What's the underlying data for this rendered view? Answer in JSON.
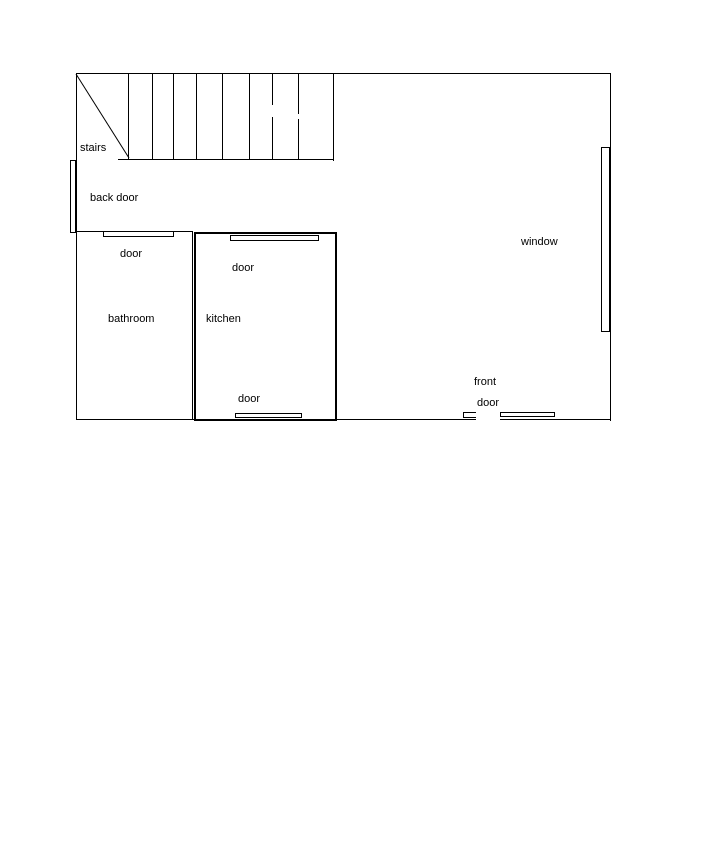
{
  "title": "house ground floor plan",
  "colors": {
    "background": "#ffffff",
    "line": "#000000"
  },
  "floorplan": {
    "labels": {
      "stairs": "stairs",
      "back_door": "back door",
      "bathroom_door": "door",
      "bathroom": "bathroom",
      "kitchen_top_door": "door",
      "kitchen": "kitchen",
      "kitchen_bottom_door": "door",
      "window": "window",
      "front_door_line1": "front",
      "front_door_line2": "door"
    },
    "walls": [
      {
        "name": "top-wall",
        "x": 76,
        "y": 73,
        "w": 535,
        "h": 1
      },
      {
        "name": "left-wall",
        "x": 76,
        "y": 73,
        "w": 1,
        "h": 347
      },
      {
        "name": "right-wall",
        "x": 610,
        "y": 73,
        "w": 1,
        "h": 348
      },
      {
        "name": "bottom-wall-left",
        "x": 76,
        "y": 419,
        "w": 400,
        "h": 1
      },
      {
        "name": "bottom-wall-right",
        "x": 500,
        "y": 419,
        "w": 111,
        "h": 1
      },
      {
        "name": "stairs-right-wall",
        "x": 333,
        "y": 73,
        "w": 1,
        "h": 88
      },
      {
        "name": "stairs-bottom-line",
        "x": 118,
        "y": 159,
        "w": 216,
        "h": 1
      },
      {
        "name": "stair-tread-1",
        "x": 128,
        "y": 74,
        "w": 1,
        "h": 85
      },
      {
        "name": "stair-tread-2",
        "x": 152,
        "y": 74,
        "w": 1,
        "h": 85
      },
      {
        "name": "stair-tread-3",
        "x": 173,
        "y": 74,
        "w": 1,
        "h": 85
      },
      {
        "name": "stair-tread-4",
        "x": 196,
        "y": 74,
        "w": 1,
        "h": 85
      },
      {
        "name": "stair-tread-5",
        "x": 222,
        "y": 74,
        "w": 1,
        "h": 85
      },
      {
        "name": "stair-tread-6",
        "x": 249,
        "y": 74,
        "w": 1,
        "h": 85
      },
      {
        "name": "stair-tread-7-upper",
        "x": 272,
        "y": 74,
        "w": 1,
        "h": 31
      },
      {
        "name": "stair-tread-7-lower",
        "x": 272,
        "y": 117,
        "w": 1,
        "h": 42
      },
      {
        "name": "stair-tread-8-upper",
        "x": 298,
        "y": 74,
        "w": 1,
        "h": 40
      },
      {
        "name": "stair-tread-8-lower",
        "x": 298,
        "y": 119,
        "w": 1,
        "h": 40
      },
      {
        "name": "bathroom-top-wall",
        "x": 76,
        "y": 231,
        "w": 117,
        "h": 1
      },
      {
        "name": "bathroom-right-wall",
        "x": 192,
        "y": 231,
        "w": 1,
        "h": 189
      },
      {
        "name": "kitchen-left-wall",
        "x": 194,
        "y": 232,
        "w": 2,
        "h": 189
      },
      {
        "name": "kitchen-top-wall",
        "x": 194,
        "y": 232,
        "w": 143,
        "h": 2
      },
      {
        "name": "kitchen-right-wall",
        "x": 335,
        "y": 232,
        "w": 2,
        "h": 189
      },
      {
        "name": "kitchen-bottom-wall",
        "x": 194,
        "y": 419,
        "w": 143,
        "h": 2
      }
    ],
    "openings": [
      {
        "name": "back-door-symbol",
        "x": 70,
        "y": 160,
        "w": 6,
        "h": 73
      },
      {
        "name": "bathroom-door-symbol",
        "x": 103,
        "y": 231,
        "w": 71,
        "h": 6
      },
      {
        "name": "kitchen-top-door-symbol",
        "x": 230,
        "y": 235,
        "w": 89,
        "h": 6
      },
      {
        "name": "kitchen-bottom-door-symbol",
        "x": 235,
        "y": 413,
        "w": 67,
        "h": 5
      },
      {
        "name": "front-door-jamb-symbol",
        "x": 463,
        "y": 412,
        "w": 13,
        "h": 6,
        "open": "right"
      },
      {
        "name": "front-door-leaf-symbol",
        "x": 500,
        "y": 412,
        "w": 55,
        "h": 5
      },
      {
        "name": "window-symbol",
        "x": 601,
        "y": 147,
        "w": 9,
        "h": 185
      }
    ],
    "stairs_diagonal": {
      "x1": 76,
      "y1": 74,
      "x2": 129,
      "y2": 158
    }
  }
}
